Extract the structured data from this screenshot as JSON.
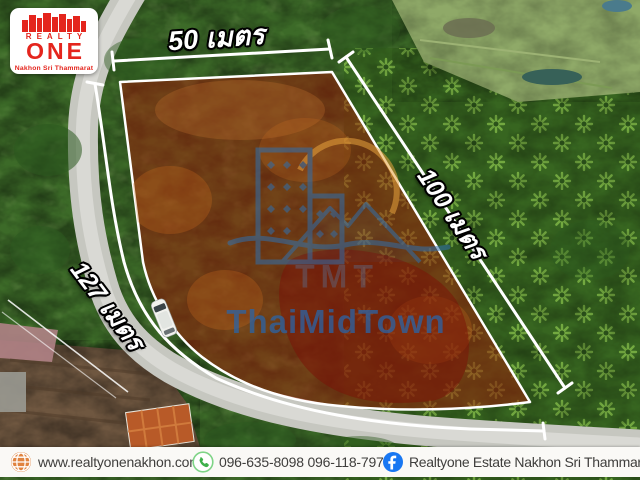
{
  "logo": {
    "brand_top": "REALTY",
    "brand_main": "ONE",
    "subtitle": "Nakhon Sri Thammarat"
  },
  "plot_dimensions": {
    "top_width_label": "50 เมตร",
    "right_depth_label": "100 เมตร",
    "left_frontage_label": "127 เมตร"
  },
  "watermark": {
    "abbr": "TMT",
    "name": "ThaiMidTown"
  },
  "footer": {
    "website": "www.realtyonenakhon.com",
    "phones": "096-635-8098 096-118-7977",
    "facebook_page": "Realtyone Estate Nakhon Sri Thammarat"
  },
  "colors": {
    "logo_red": "#e4251d",
    "facebook_blue": "#1877f2",
    "phone_green": "#4fbd5a",
    "globe_orange": "#e0833f",
    "plot_overlay_red": "#a61c08",
    "dimension_line_white": "#ffffff",
    "watermark_blue": "#2f6fad",
    "watermark_sun_orange": "#e8a33d",
    "footer_background": "#faf9f6"
  }
}
